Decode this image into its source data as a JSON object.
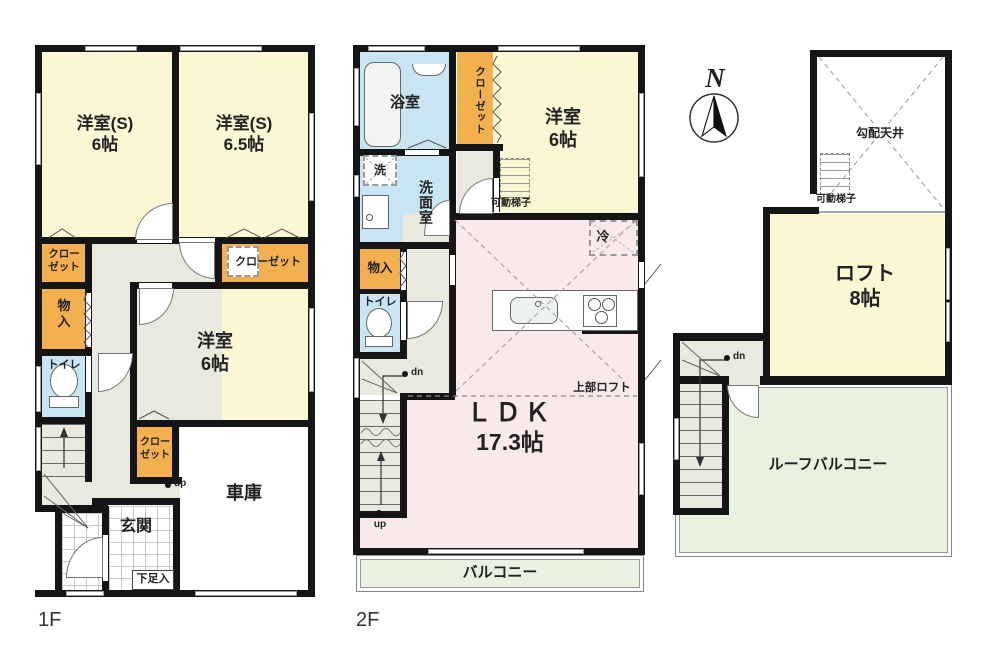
{
  "colors": {
    "wall": "#151515",
    "room_yellow": "#fbf6d3",
    "closet_orange": "#f2b04e",
    "wet_area_blue": "#c9e4f2",
    "ldk_pink": "#f9e9ea",
    "balcony_green": "#e9f1e1",
    "hall_grey": "#e9e9df"
  },
  "floor1": {
    "floor_label": "1F",
    "western_s6": "洋室(S)\n6帖",
    "western_s65": "洋室(S)\n6.5帖",
    "closet_left": "クロー\nゼット",
    "closet_right": "クローゼット",
    "storage": "物\n入",
    "toilet": "トイレ",
    "western6": "洋室\n6帖",
    "closet_small": "クロー\nゼット",
    "garage": "車庫",
    "entrance": "玄関",
    "shoe_box": "下足入",
    "stairs_up": "up"
  },
  "floor2": {
    "floor_label": "2F",
    "bathroom": "浴室",
    "closet": "クローゼット",
    "western6": "洋室\n6帖",
    "ladder": "可動梯子",
    "washer": "洗",
    "washroom": "洗面室",
    "storage": "物入",
    "toilet": "トイレ",
    "fridge": "冷",
    "upper_loft": "上部ロフト",
    "ldk_name": "ＬＤＫ",
    "ldk_size": "17.3帖",
    "balcony": "バルコニー",
    "stairs_dn": "dn",
    "stairs_up": "up"
  },
  "loft": {
    "compass": "N",
    "sloped_ceiling": "勾配天井",
    "ladder": "可動梯子",
    "loft_room": "ロフト\n8帖",
    "roof_balcony": "ルーフバルコニー",
    "stairs_dn": "dn"
  }
}
